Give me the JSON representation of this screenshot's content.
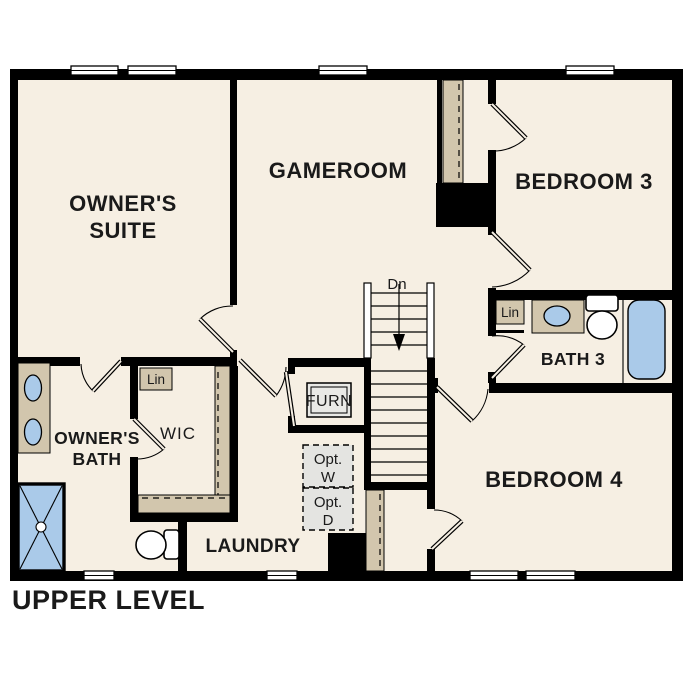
{
  "title": "UPPER LEVEL",
  "colors": {
    "floor": "#f6efe3",
    "wall": "#000000",
    "cabinetry_tan": "#d2c6ad",
    "fixture_blue": "#aacae9",
    "optional_gray": "#e4e4e1",
    "background": "#ffffff"
  },
  "rooms": {
    "owners_suite": {
      "line1": "OWNER'S",
      "line2": "SUITE"
    },
    "gameroom": {
      "label": "GAMEROOM"
    },
    "bedroom3": {
      "label": "BEDROOM 3"
    },
    "bath3": {
      "label": "BATH 3"
    },
    "bedroom4": {
      "label": "BEDROOM 4"
    },
    "owners_bath": {
      "line1": "OWNER'S",
      "line2": "BATH"
    },
    "wic": {
      "label": "WIC"
    },
    "laundry": {
      "label": "LAUNDRY"
    }
  },
  "annotations": {
    "stairs_down": "Dn",
    "wic_linen": "Lin",
    "bath3_linen": "Lin",
    "furnace": "FURN",
    "opt_washer": {
      "line1": "Opt.",
      "line2": "W"
    },
    "opt_dryer": {
      "line1": "Opt.",
      "line2": "D"
    }
  }
}
